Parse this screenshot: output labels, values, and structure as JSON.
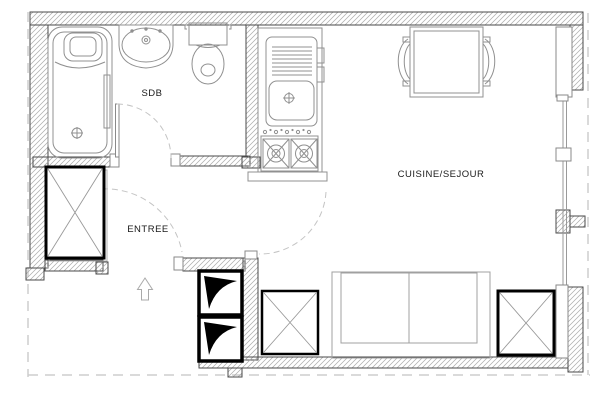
{
  "plan": {
    "labels": {
      "bathroom": "SDB",
      "entrance": "ENTREE",
      "kitchen_living": "CUISINE/SEJOUR"
    },
    "fixture_icons": [
      "bathtub-icon",
      "washbasin-icon",
      "toilet-icon",
      "kitchen-sink-icon",
      "stove-icon",
      "dining-table-icon",
      "chair-icon",
      "sofa-icon",
      "wardrobe-x-icon",
      "duct-box-icon",
      "entrance-arrow-icon",
      "door-swing-arc",
      "window-wall"
    ],
    "colors": {
      "background": "#ffffff",
      "wall_outline": "#4a4a4a",
      "wall_hatch": "#ababab",
      "fixture_line": "#909090",
      "heavy_element": "#000000",
      "dashed_boundary": "#cdcdcd",
      "label_text": "#1a1a1a"
    }
  }
}
